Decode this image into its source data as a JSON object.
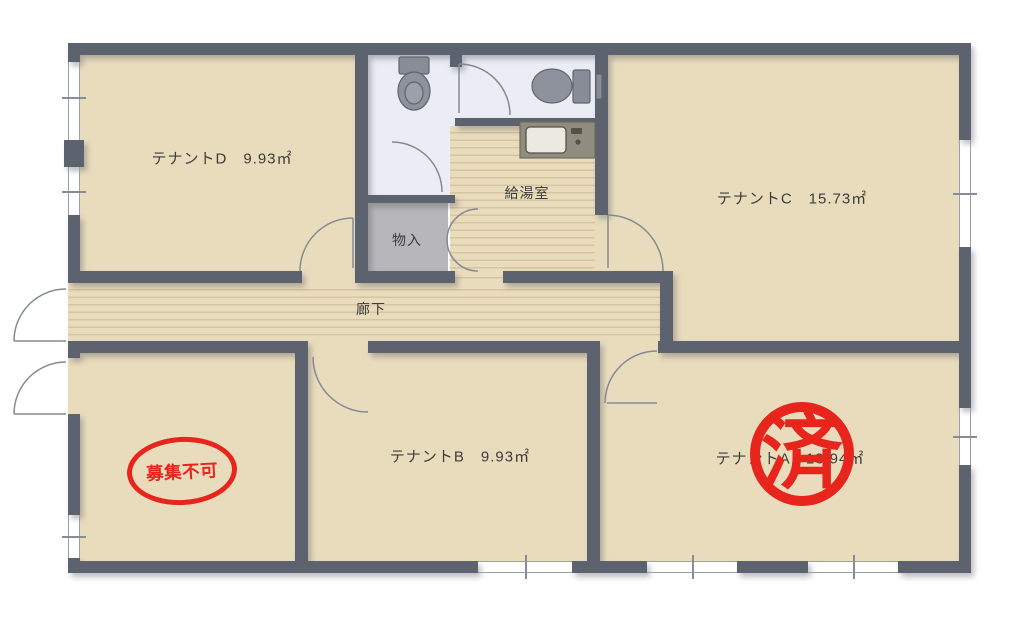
{
  "floorplan": {
    "rooms": {
      "tenant_d": {
        "label": "テナントD　9.93㎡"
      },
      "tenant_c": {
        "label": "テナントC　15.73㎡"
      },
      "tenant_b": {
        "label": "テナントB　9.93㎡"
      },
      "tenant_a": {
        "label": "テナントA　13.94㎡"
      },
      "kitchen": {
        "label": "給湯室"
      },
      "storage": {
        "label": "物入"
      },
      "corridor": {
        "label": "廊下"
      }
    },
    "stamps": {
      "occupied": {
        "text": "済",
        "color": "#e8251d"
      },
      "not_available": {
        "text": "募集不可",
        "color": "#e8251d"
      }
    }
  }
}
